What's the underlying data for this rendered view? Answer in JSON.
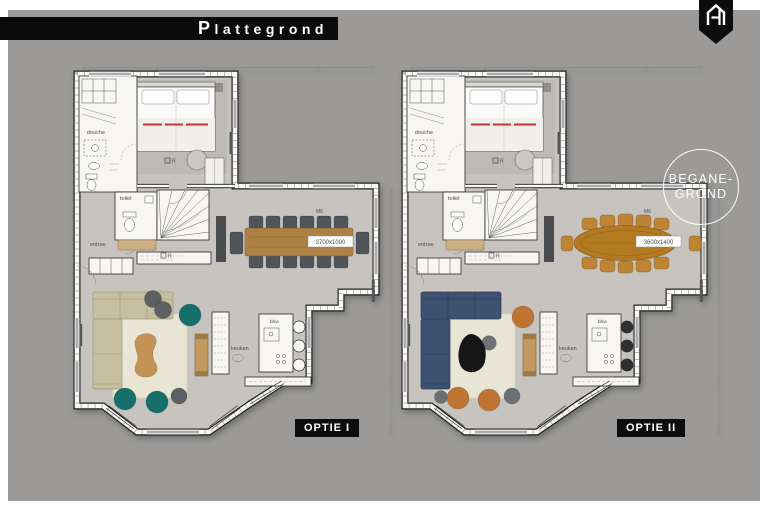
{
  "theme": {
    "background": "#9b9a98",
    "frame": "#ffffff",
    "band": "#0b0b0b",
    "text_light": "#ffffff",
    "floor": "#c7c4bf",
    "room": "#f7f6f3",
    "wall": "#f8f8f6",
    "line": "#222222",
    "rug": "#e9e5d5",
    "red": "#c0392b"
  },
  "header": {
    "title": "Plattegrond"
  },
  "logo": {
    "name": "house-shield-logo"
  },
  "floor_badge": {
    "line1": "BEGANE-",
    "line2": "GROND"
  },
  "plans": [
    {
      "id": "optie-1",
      "caption": "OPTIE I",
      "variant": "rect",
      "rooms": {
        "shower": "douche",
        "toilet": "toilet",
        "hall": "entree",
        "kitchen": "keuken"
      },
      "labels": {
        "dining_table_size": "3700x1000",
        "wall_tag": "M6",
        "island": "bhw",
        "radiator": "R"
      },
      "palette": {
        "sofa": "#c6c0a0",
        "sofa_line": "#9f9a7d",
        "pouf": "#15706c",
        "pouf_alt": "#5c6062",
        "table": "#ad8044",
        "chair": "#4f555a",
        "coffee": "#c49254",
        "stool": "#f6f6f4"
      }
    },
    {
      "id": "optie-2",
      "caption": "OPTIE II",
      "variant": "oval",
      "rooms": {
        "shower": "douche",
        "toilet": "toilet",
        "hall": "entree",
        "kitchen": "keuken"
      },
      "labels": {
        "dining_table_size": "3600x1400",
        "wall_tag": "M6",
        "island": "bhw",
        "radiator": "R"
      },
      "palette": {
        "sofa": "#3c5271",
        "sofa_line": "#2b3c55",
        "pouf": "#c07434",
        "pouf_alt": "#6d7072",
        "table": "#b47a22",
        "chair": "#bd8436",
        "coffee": "#161616",
        "stool": "#2e2f31"
      }
    }
  ]
}
